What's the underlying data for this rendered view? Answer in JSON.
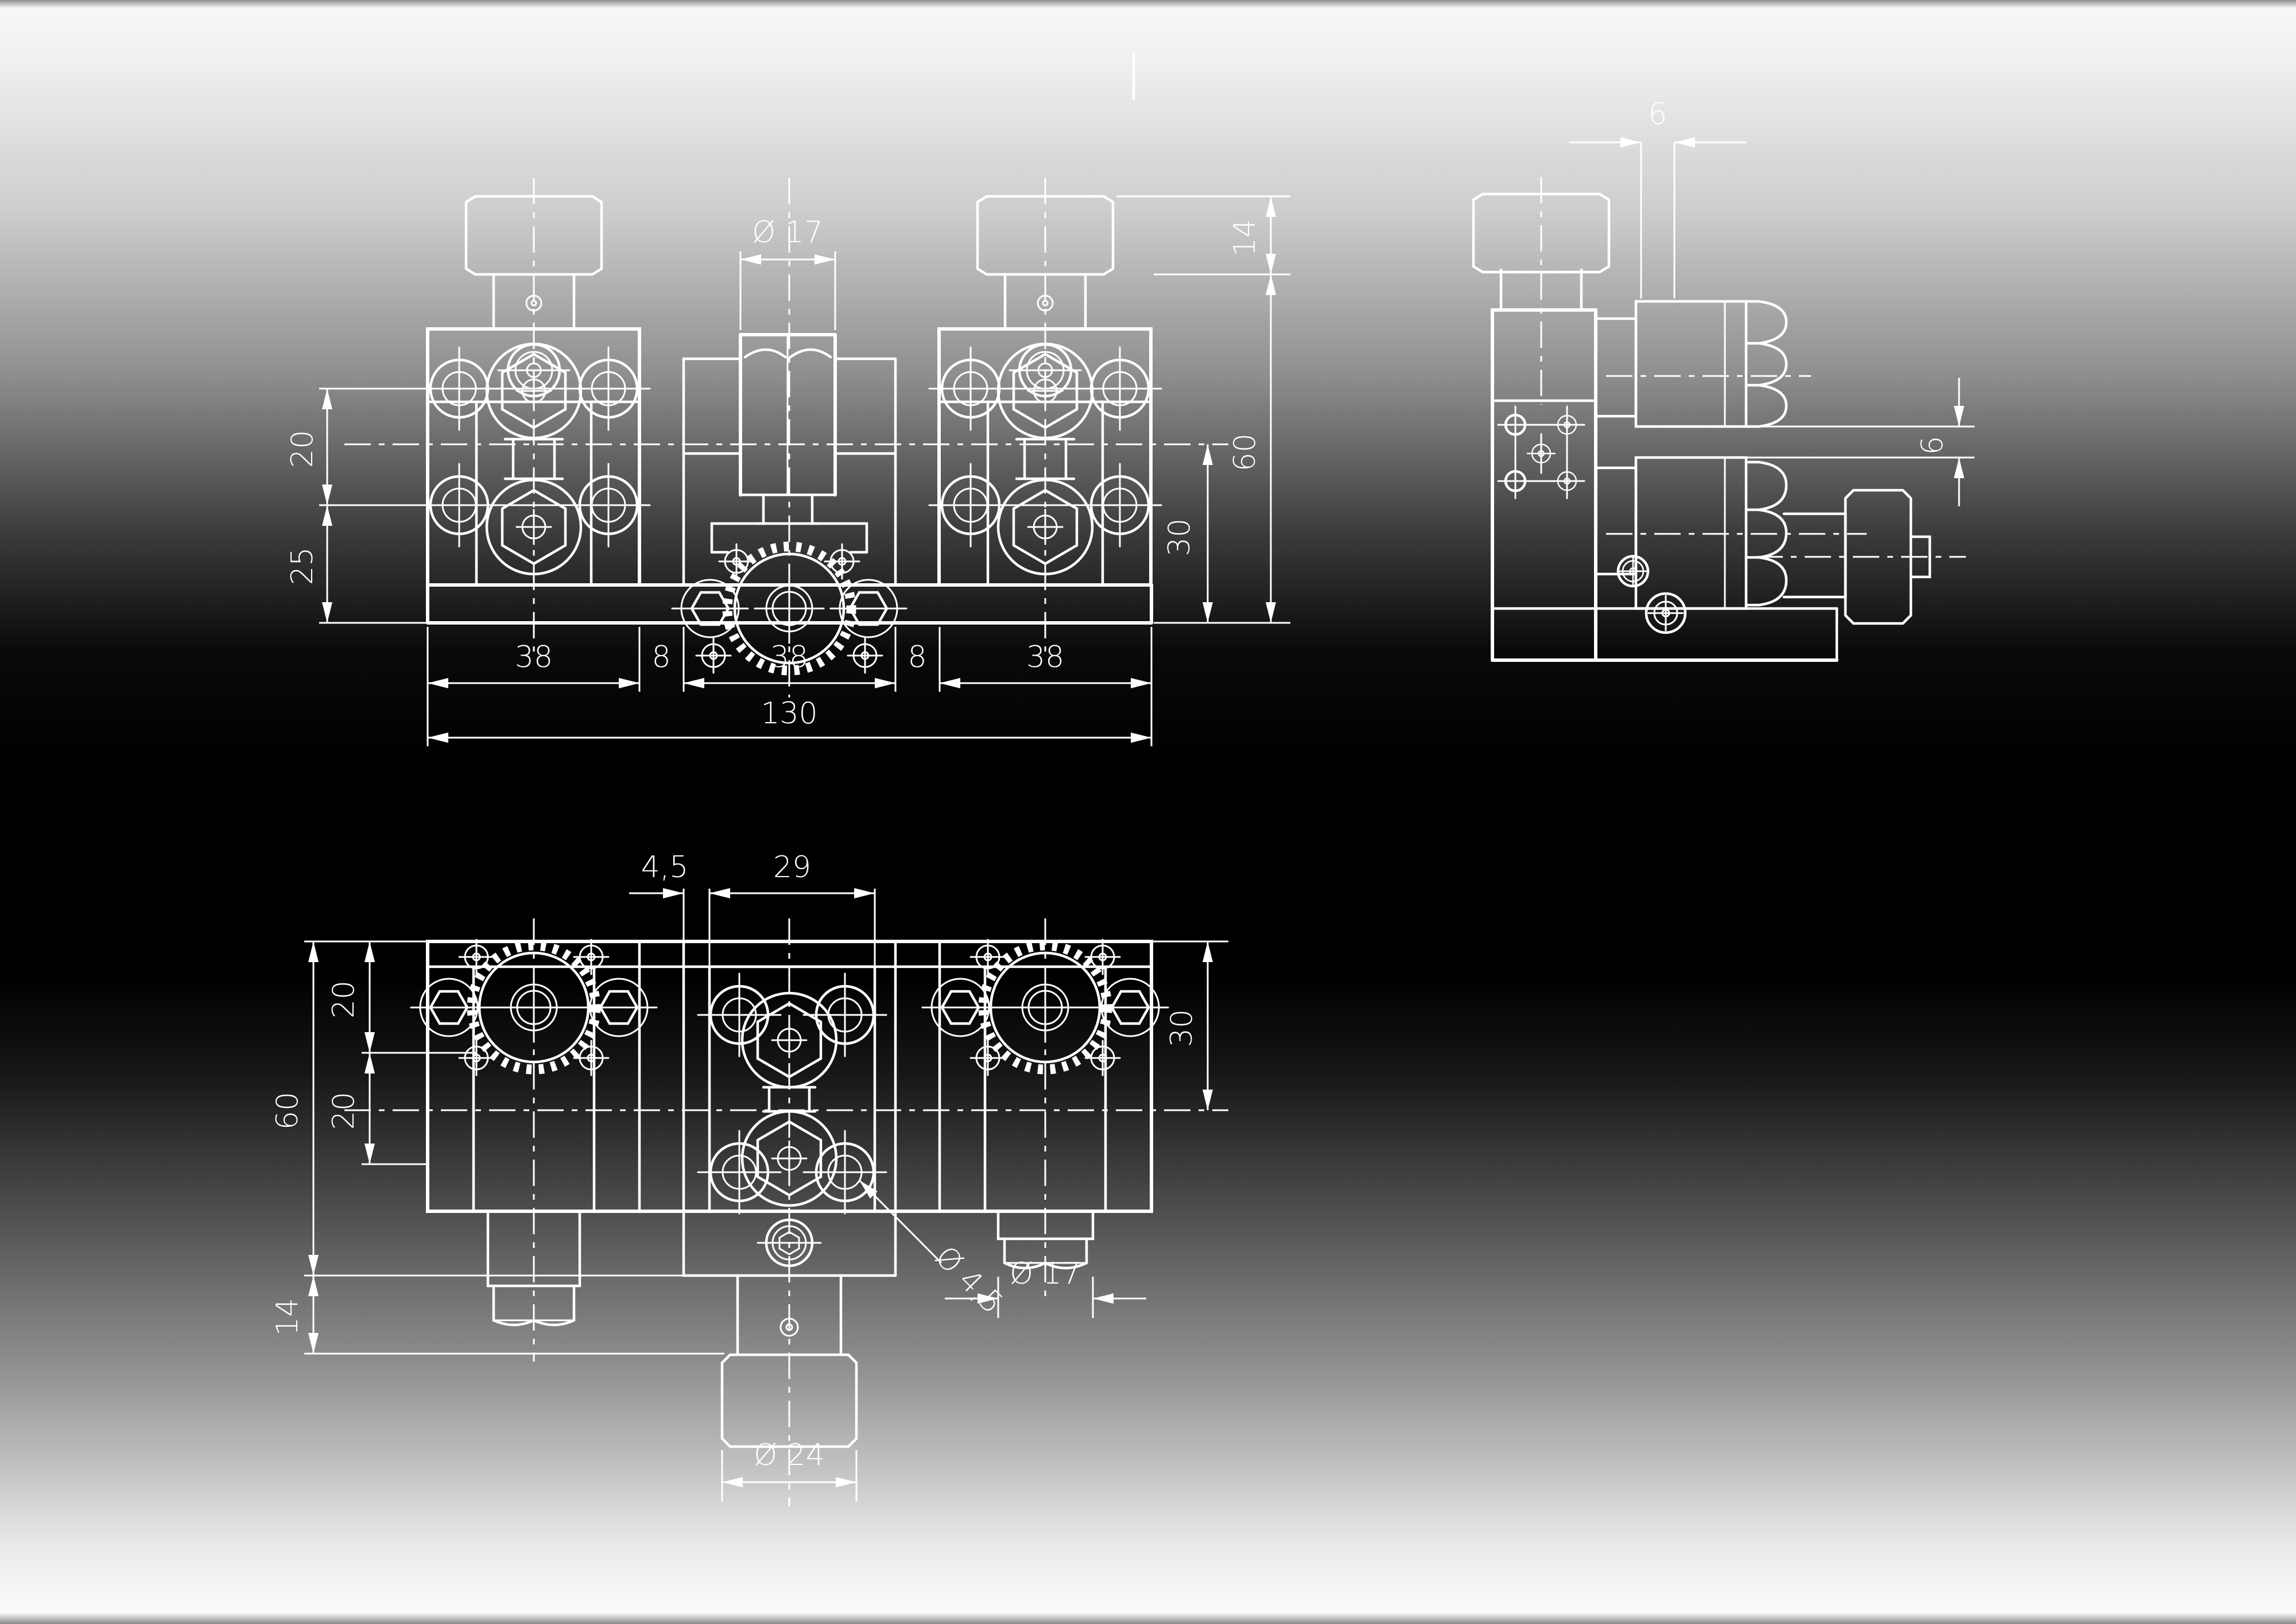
{
  "page": {
    "line_color": "#ffffff",
    "background_top": "#f7f7f7",
    "background_middle": "#000000",
    "background_bottom": "#fbfbfb"
  },
  "drawing": {
    "description": "Three-view technical drawing of a dual knurled-knob kinematic positioning stage",
    "front_view": {
      "dims": {
        "dia17": "Ø 17",
        "d20": "20",
        "d25": "25",
        "d14": "14",
        "d60": "60",
        "d30": "30",
        "d38a": "38",
        "d8a": "8",
        "d38b": "38",
        "d8b": "8",
        "d38c": "38",
        "d130": "130"
      }
    },
    "side_view": {
      "dims": {
        "d6_top": "6",
        "d6_right": "6"
      }
    },
    "plan_view": {
      "dims": {
        "d45": "4,5",
        "d29": "29",
        "d20a": "20",
        "d20b": "20",
        "d60": "60",
        "d14": "14",
        "d30": "30",
        "dia45": "Ø 4,5",
        "dia17": "Ø 17",
        "dia24": "Ø 24"
      }
    }
  }
}
